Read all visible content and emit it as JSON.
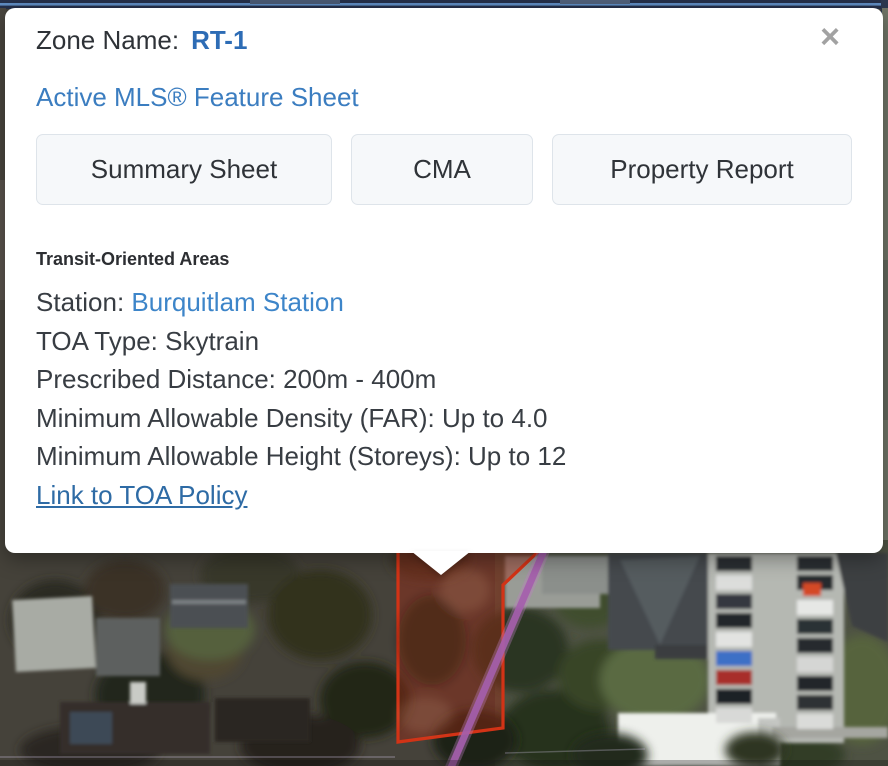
{
  "popup": {
    "zone": {
      "label": "Zone Name:",
      "value": "RT-1"
    },
    "close_icon": "×",
    "feature_sheet_link": "Active MLS® Feature Sheet",
    "buttons": [
      {
        "label": "Summary Sheet"
      },
      {
        "label": "CMA"
      },
      {
        "label": "Property Report"
      }
    ],
    "toa": {
      "heading": "Transit-Oriented Areas",
      "station_label": "Station:",
      "station_link": "Burquitlam Station",
      "type_line": "TOA Type: Skytrain",
      "distance_line": "Prescribed Distance: 200m - 400m",
      "density_line": "Minimum Allowable Density (FAR): Up to 4.0",
      "height_line": "Minimum Allowable Height (Storeys): Up to 12",
      "policy_link": "Link to TOA Policy"
    }
  },
  "map": {
    "type": "aerial-satellite-imagery",
    "parcel_outline_color": "#d23316",
    "parcel_fill_color": "rgba(160,40,18,0.42)",
    "toa_boundary_color": "#a55fad",
    "top_route_line_color": "#5f8cc2"
  },
  "colors": {
    "link_blue": "#3b7dc0",
    "zone_value_blue": "#2d6cb5",
    "station_link_blue": "#3d85c9",
    "policy_link_blue": "#2e6ba5",
    "text_dark": "#383d43",
    "button_bg": "#f6f8fa"
  }
}
